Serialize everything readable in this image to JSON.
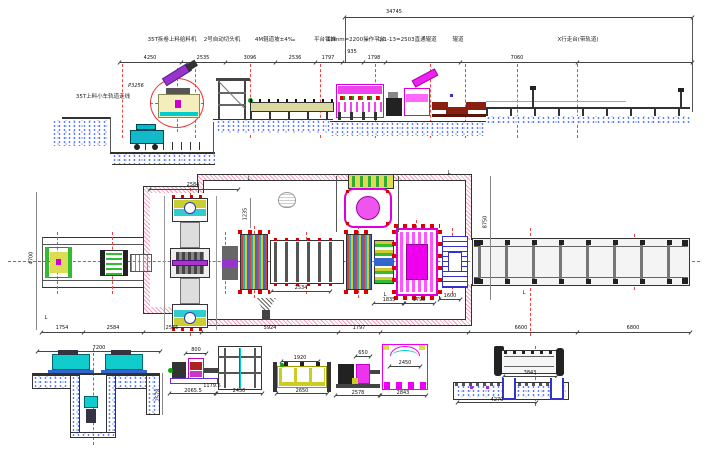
{
  "elevation": {
    "overall_dim": "34745",
    "dims": [
      "4250",
      "2535",
      "3096",
      "2536",
      "1797",
      "935",
      "1798",
      "7060"
    ],
    "equipment_labels": [
      "35T拆卷上料给料机",
      "2号自动切头机",
      "4M辊道坡±4‰",
      "平台钢梯",
      "12mm=2200操作平台",
      "Q/1-13=2503直通辊道",
      "辊道",
      "X行走台(带轨道)"
    ],
    "pit_label": "35T上料小车轨道走线",
    "part_label": "P3256"
  },
  "plan": {
    "bottom_dims": [
      "1754",
      "2584",
      "2535",
      "5924",
      "1797",
      "6600",
      "6800"
    ],
    "top_dim": "2584",
    "left_dim": "4700",
    "right_dim": "8750",
    "inner_dims": [
      "2534",
      "1835",
      "1798",
      "1600",
      "1235"
    ],
    "section_mark": "L"
  },
  "details": {
    "a": {
      "top": "7200",
      "side": "2578"
    },
    "b": {
      "top": "800",
      "mid": "1179.5",
      "left": "2065.5",
      "right": "2450"
    },
    "c": {
      "top": "1920",
      "bottom": "2650"
    },
    "d": {
      "top": "650",
      "inner": "2450",
      "left": "2578",
      "right": "2843"
    },
    "e": {
      "top": "3843",
      "bottom": "4270"
    }
  }
}
